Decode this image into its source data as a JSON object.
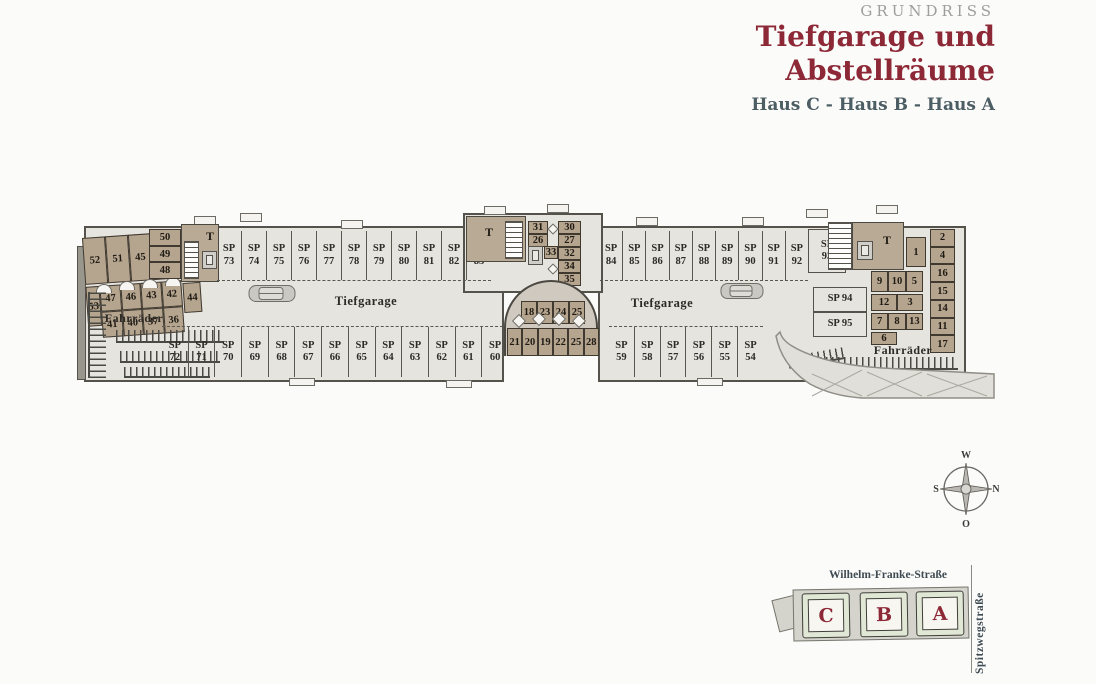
{
  "header": {
    "eyebrow": "GRUNDRISS",
    "title_line1": "Tiefgarage und",
    "title_line2": "Abstellräume",
    "subtitle": "Haus C - Haus B - Haus A"
  },
  "plan": {
    "labels": {
      "tiefgarage_left": "Tiefgarage",
      "tiefgarage_right": "Tiefgarage",
      "fahrraeder_left": "Fahrräder",
      "fahrraeder_right": "Fahrräder",
      "stairs_left": "T",
      "stairs_mid": "T",
      "stairs_right": "T"
    },
    "parking": {
      "prefix": "SP",
      "top_left": [
        "73",
        "74",
        "75",
        "76",
        "77",
        "78",
        "79",
        "80",
        "81",
        "82",
        "83"
      ],
      "top_right": [
        "84",
        "85",
        "86",
        "87",
        "88",
        "89",
        "90",
        "91",
        "92"
      ],
      "corner_right": "93",
      "bottom_left": [
        "72",
        "71",
        "70",
        "69",
        "68",
        "67",
        "66",
        "65",
        "64",
        "63",
        "62",
        "61",
        "60"
      ],
      "bottom_right": [
        "59",
        "58",
        "57",
        "56",
        "55",
        "54"
      ],
      "sp94": "SP 94",
      "sp95": "SP 95"
    },
    "storage": {
      "left_top_row": [
        "52",
        "51",
        "45",
        "39",
        "38"
      ],
      "left_stack": [
        "50",
        "49",
        "48"
      ],
      "left_vertical": "53",
      "left_mid_row": [
        "47",
        "46",
        "43",
        "42"
      ],
      "left_mid_extra": "44",
      "left_bottom_row": [
        "41",
        "40",
        "37",
        "36"
      ],
      "mid_left_stack": [
        "31",
        "26"
      ],
      "mid_center": "33",
      "mid_right_stack": [
        "30",
        "27",
        "32",
        "34",
        "35"
      ],
      "bump_top": [
        "18",
        "23",
        "24",
        "25"
      ],
      "bump_bottom": [
        "21",
        "20",
        "19",
        "22",
        "25",
        "28"
      ],
      "right_single": "1",
      "right_column": [
        "2",
        "4",
        "16",
        "15",
        "14",
        "11",
        "17"
      ],
      "right_cluster_row1": [
        "9",
        "10",
        "5"
      ],
      "right_cluster_row2": [
        "12",
        "3"
      ],
      "right_cluster_row3": [
        "7",
        "8",
        "13"
      ],
      "right_cluster_row4": [
        "6"
      ]
    }
  },
  "compass": {
    "top": "W",
    "right": "N",
    "bottom": "O",
    "left": "S"
  },
  "sitemap": {
    "street_top": "Wilhelm-Franke-Straße",
    "street_right": "Spitzwegstraße",
    "buildings": [
      "C",
      "B",
      "A"
    ]
  },
  "colors": {
    "accent": "#8d2837",
    "subtitle": "#4c5d63",
    "eyebrow": "#9e9e9e",
    "storage_tan": "#b5a48e",
    "floor": "#e5e4df",
    "wall": "#55524b"
  }
}
